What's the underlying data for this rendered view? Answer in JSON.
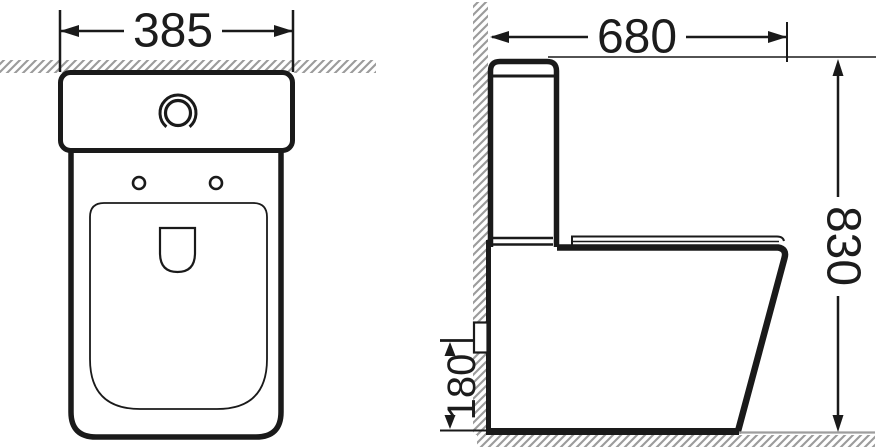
{
  "drawing": {
    "dimensions": {
      "front_width": "385",
      "side_depth": "680",
      "side_height": "830",
      "inlet_height": "180"
    },
    "colors": {
      "line": "#1a1a1a",
      "text": "#1c1c1c",
      "hatch_gray": "#9b9b9b",
      "floor_line_gray": "#9e9e9e",
      "background": "#ffffff"
    }
  }
}
